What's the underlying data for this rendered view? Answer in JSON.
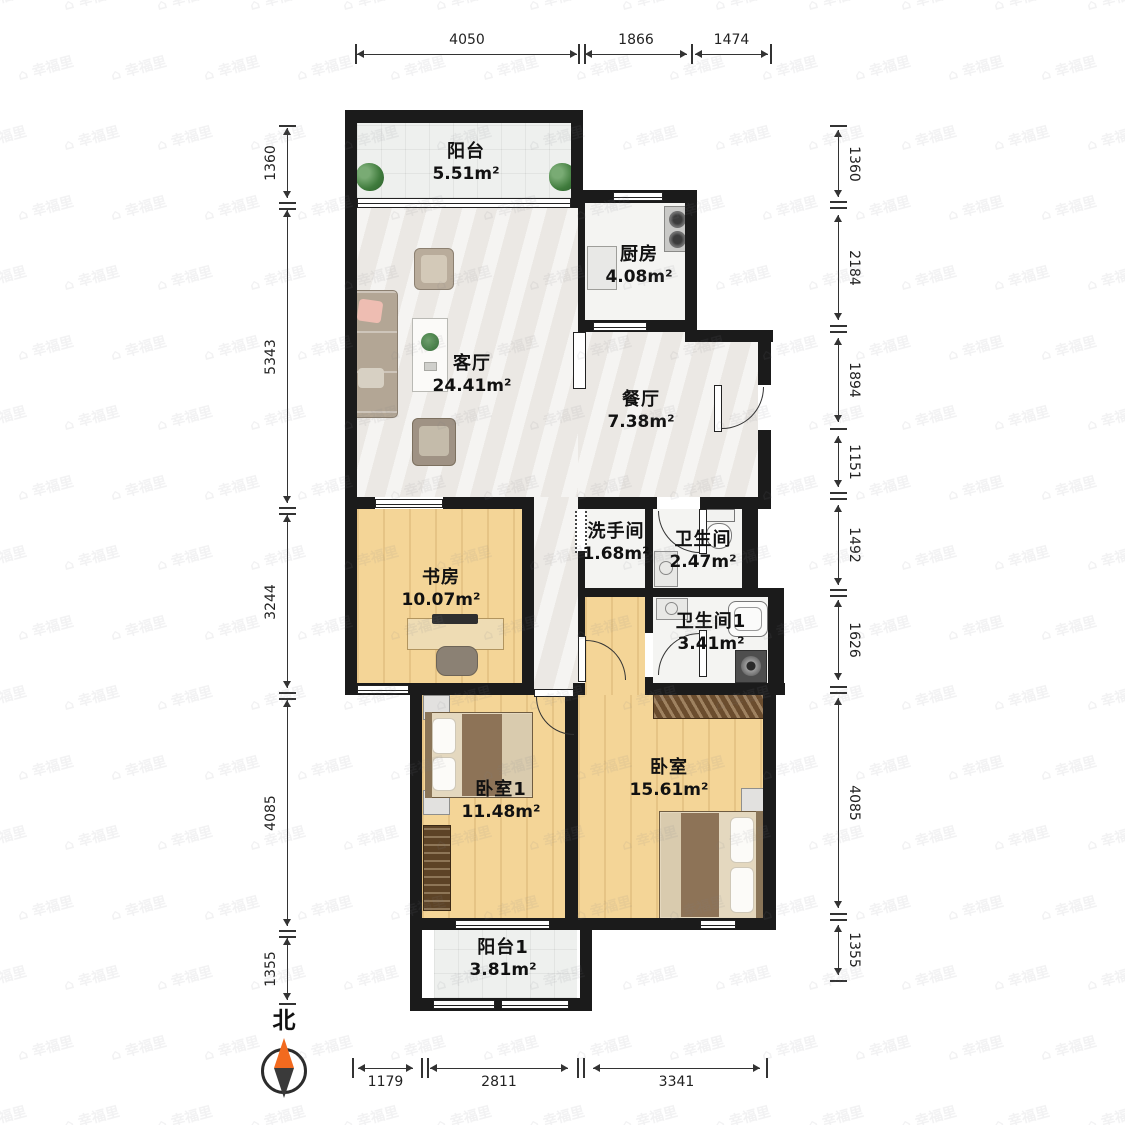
{
  "compass": {
    "north_label": "北"
  },
  "watermark": {
    "icon": "⌂",
    "text": "幸福里"
  },
  "rooms": [
    {
      "id": "balcony",
      "name": "阳台",
      "area": "5.51m²"
    },
    {
      "id": "kitchen",
      "name": "厨房",
      "area": "4.08m²"
    },
    {
      "id": "living",
      "name": "客厅",
      "area": "24.41m²"
    },
    {
      "id": "dining",
      "name": "餐厅",
      "area": "7.38m²"
    },
    {
      "id": "washroom",
      "name": "洗手间",
      "area": "1.68m²"
    },
    {
      "id": "bathroom",
      "name": "卫生间",
      "area": "2.47m²"
    },
    {
      "id": "study",
      "name": "书房",
      "area": "10.07m²"
    },
    {
      "id": "bathroom1",
      "name": "卫生间1",
      "area": "3.41m²"
    },
    {
      "id": "bedroom1",
      "name": "卧室1",
      "area": "11.48m²"
    },
    {
      "id": "bedroom",
      "name": "卧室",
      "area": "15.61m²"
    },
    {
      "id": "balcony1",
      "name": "阳台1",
      "area": "3.81m²"
    }
  ],
  "dimensions": {
    "top": [
      "4050",
      "1866",
      "1474"
    ],
    "left": [
      "1360",
      "5343",
      "3244",
      "4085",
      "1355"
    ],
    "right": [
      "1360",
      "2184",
      "1894",
      "1151",
      "1492",
      "1626",
      "4085",
      "1355"
    ],
    "bottom": [
      "1179",
      "2811",
      "3341"
    ]
  },
  "colors": {
    "wall": "#1b1b1b",
    "wood_floor": "#f4d597",
    "marble_floor": "#ebe8e4",
    "tile_floor": "#f4f4f2",
    "balcony_floor": "#eef0ee",
    "compass_north": "#f26a1f",
    "dimension_text": "#222222"
  }
}
